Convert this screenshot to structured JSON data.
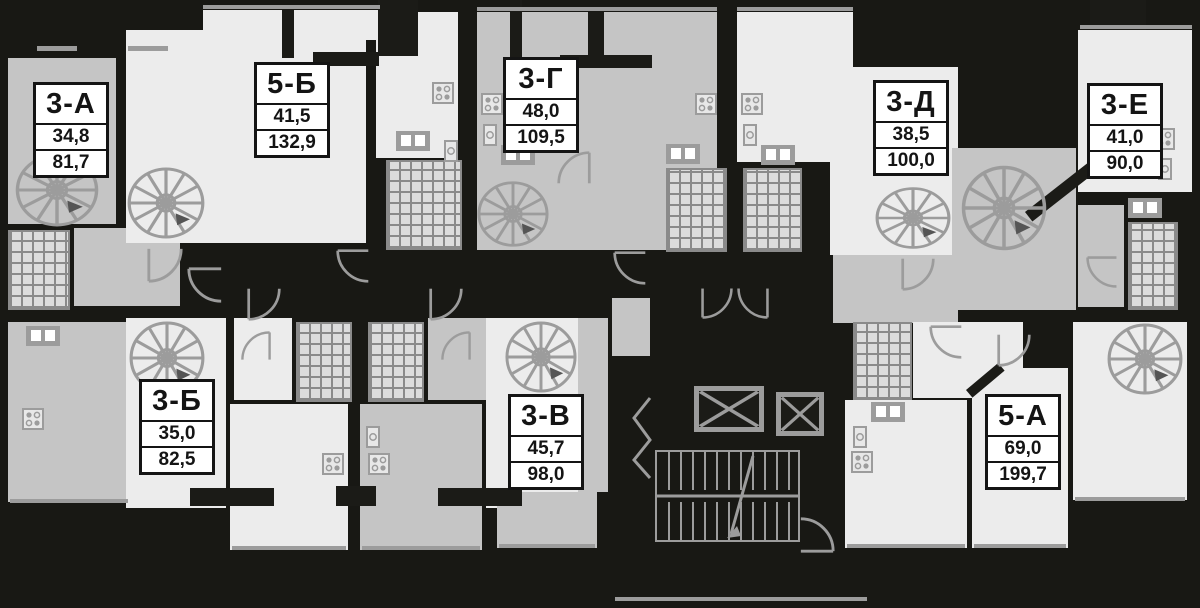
{
  "plan": {
    "type": "residential-floor-plan",
    "colors": {
      "background": "#181814",
      "walls": "#1b1b17",
      "room_gray": "#c5c5c5",
      "room_light": "#ececec",
      "symbols": "#9c9c9c",
      "label_background": "#ffffff",
      "label_text": "#141414"
    }
  },
  "apartments": [
    {
      "id": "3-А",
      "living_area": "34,8",
      "total_area": "81,7"
    },
    {
      "id": "5-Б",
      "living_area": "41,5",
      "total_area": "132,9"
    },
    {
      "id": "3-Г",
      "living_area": "48,0",
      "total_area": "109,5"
    },
    {
      "id": "3-Д",
      "living_area": "38,5",
      "total_area": "100,0"
    },
    {
      "id": "3-Е",
      "living_area": "41,0",
      "total_area": "90,0"
    },
    {
      "id": "3-Б",
      "living_area": "35,0",
      "total_area": "82,5"
    },
    {
      "id": "3-В",
      "living_area": "45,7",
      "total_area": "98,0"
    },
    {
      "id": "5-А",
      "living_area": "69,0",
      "total_area": "199,7"
    }
  ]
}
